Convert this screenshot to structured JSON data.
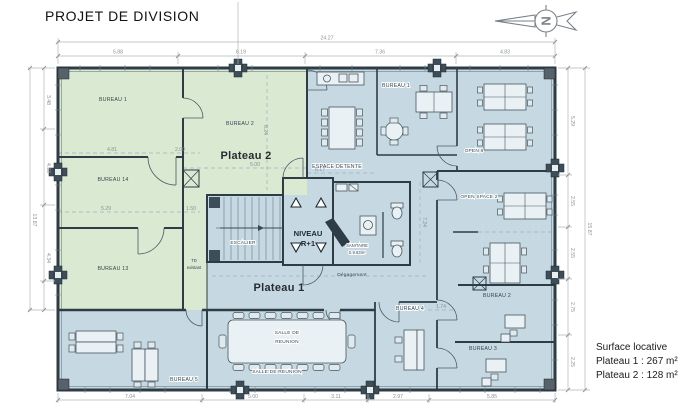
{
  "title": "PROJET DE DIVISION",
  "north": {
    "letter": "N"
  },
  "plateau2": {
    "label": "Plateau 2",
    "bureau1": "BUREAU 1",
    "bureau2": "BUREAU 2",
    "bureau14": "BUREAU 14",
    "bureau13": "BUREAU 13"
  },
  "plateau1": {
    "label": "Plateau 1",
    "bureau1": "BUREAU 1",
    "espace_detente": "ESPACE DETENTE",
    "open8": "OPEN 8",
    "open_space2": "OPEN SPACE 2",
    "bureau2": "BUREAU 2",
    "bureau3": "BUREAU 3",
    "bureau4": "BUREAU 4",
    "bureau5": "BUREAU 5",
    "salle_table_l1": "SALLE DE",
    "salle_table_l2": "REUNION",
    "salle_caption": "SALLE DE REUNION",
    "degagement": "Dégagement"
  },
  "core": {
    "escalier": "ESCALIER",
    "niveau_l1": "NIVEAU",
    "niveau_l2": "R+1",
    "sanitaire": "SANITAIRE",
    "sanitaire_area": "S.9.63m²",
    "td_l1": "TD",
    "td_l2": "existant"
  },
  "legend": {
    "line1": "Surface locative",
    "line2": "Plateau 1 : 267 m²",
    "line3": "Plateau 2 : 128 m²"
  },
  "dims": {
    "top_total": "24.27",
    "top": [
      "5.88",
      "6.19",
      "7.36",
      "4.83"
    ],
    "bottom": [
      "7.04",
      "5.00",
      "3.11",
      "2.97",
      "5.85"
    ],
    "left": [
      "3.48",
      "4.38",
      "4.34"
    ],
    "left_total": "13.87",
    "right": [
      "5.29",
      "2.55",
      "2.55",
      "2.75",
      "2.25"
    ],
    "right_total": "15.87",
    "inner": [
      "4.81",
      "2.00",
      "5.29",
      "1.50",
      "5.00",
      "6.17",
      "6.24",
      "7.24",
      "1.74"
    ]
  },
  "colors": {
    "plateau2_green": "#d9e9d2",
    "plateau1_blue": "#c6d9e2",
    "wall": "#2e3c46",
    "dimension": "#8c9298"
  }
}
